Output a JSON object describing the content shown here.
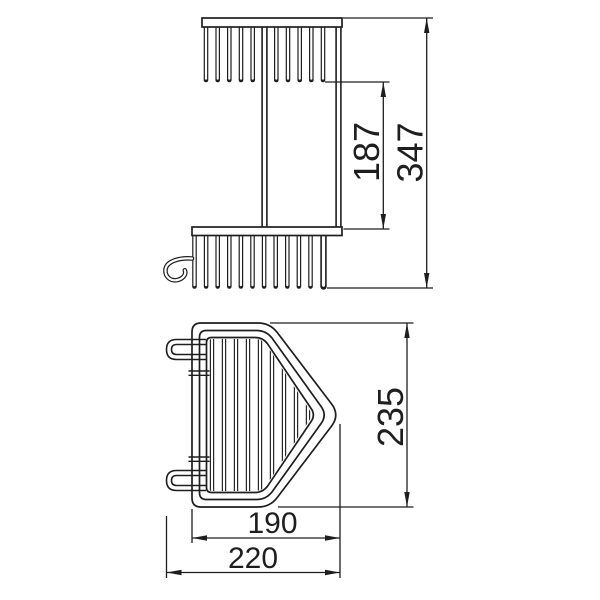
{
  "canvas": {
    "width": 600,
    "height": 600,
    "background": "#ffffff",
    "line_color": "#1e1e1e"
  },
  "drawing": {
    "type": "technical-dimension-drawing",
    "subject": "two-tier corner wire basket",
    "views": [
      {
        "name": "side-view",
        "position": "top"
      },
      {
        "name": "top-view",
        "position": "bottom"
      }
    ]
  },
  "dimensions": {
    "tier_spacing": {
      "label": "187",
      "value_mm": 187,
      "orientation": "vertical-rotated",
      "view": "side-view"
    },
    "overall_height": {
      "label": "347",
      "value_mm": 347,
      "orientation": "vertical-rotated",
      "view": "side-view"
    },
    "depth": {
      "label": "235",
      "value_mm": 235,
      "orientation": "vertical-rotated",
      "view": "top-view"
    },
    "basket_width": {
      "label": "190",
      "value_mm": 190,
      "orientation": "horizontal",
      "view": "top-view"
    },
    "overall_width": {
      "label": "220",
      "value_mm": 220,
      "orientation": "horizontal",
      "view": "top-view"
    }
  },
  "geometry": {
    "side_view": {
      "upper_bar": [
        202,
        18,
        140,
        9
      ],
      "lower_bar": [
        192,
        227,
        150,
        8.5
      ],
      "rails_x": [
        264.5,
        338.5
      ],
      "rails_y": [
        24,
        229
      ],
      "upper_teeth_x": [
        206,
        217.7,
        229.3,
        241,
        252.7,
        276.3,
        288,
        299.7,
        311.3,
        323
      ],
      "upper_teeth_y": [
        24,
        80
      ],
      "lower_teeth_x": [
        194.5,
        206.1,
        217.7,
        229.3,
        240.9,
        252.5,
        264.1,
        275.7,
        287.3,
        298.9,
        310.5
      ],
      "lower_thick_x": 323.5,
      "lower_teeth_y": [
        232,
        286.5
      ],
      "hook_path": "M 192,258.5 C 180,257.5 166.5,261 165.5,269.5 C 164.8,277 171,281.5 177.5,280 C 183.5,278.6 186.5,274 184.8,270.3"
    },
    "top_view": {
      "insets": [
        0,
        7.5,
        14.5
      ],
      "clip_inset": 16,
      "wires_x": [
        212,
        224,
        236,
        248,
        260,
        272,
        284,
        296,
        308,
        320
      ],
      "wires_y": [
        330,
        500
      ],
      "hook_cy": [
        349.5,
        480.5
      ],
      "hook_x": [
        166.5,
        206
      ],
      "ticks": {
        "x": [
          188.5,
          209.5
        ],
        "y_pairs": [
          [
            371,
            375.3
          ],
          [
            457,
            461.3
          ]
        ]
      }
    },
    "dims": {
      "ext_lines": [
        [
          325,
          82,
          389.5,
          82
        ],
        [
          343.5,
          229,
          389.5,
          229
        ],
        [
          343,
          18,
          433,
          18
        ],
        [
          327,
          288,
          433,
          288
        ],
        [
          270,
          323,
          413.5,
          323
        ],
        [
          278,
          507,
          413.5,
          507
        ],
        [
          340,
          424,
          340,
          578
        ],
        [
          192,
          509,
          192,
          543
        ],
        [
          166.5,
          516,
          166.5,
          578
        ]
      ],
      "lines": [
        {
          "x1": 383.3,
          "y1": 82,
          "x2": 383.3,
          "y2": 229,
          "a1": "up",
          "a2": "down"
        },
        {
          "x1": 426.7,
          "y1": 18,
          "x2": 426.7,
          "y2": 288,
          "a1": "up",
          "a2": "down"
        },
        {
          "x1": 407,
          "y1": 323,
          "x2": 407,
          "y2": 507,
          "a1": "up",
          "a2": "down"
        },
        {
          "x1": 192,
          "y1": 538,
          "x2": 340,
          "y2": 538,
          "a1": "left",
          "a2": "right"
        },
        {
          "x1": 166.5,
          "y1": 572.5,
          "x2": 340,
          "y2": 572.5,
          "a1": "left",
          "a2": "right"
        }
      ],
      "arrow": {
        "len": 15,
        "halfw": 2.7
      }
    }
  }
}
